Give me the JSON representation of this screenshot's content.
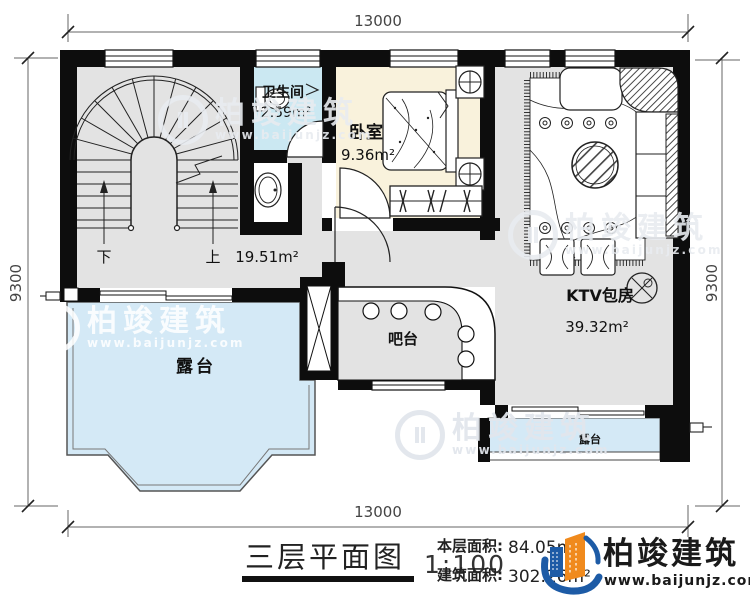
{
  "plan": {
    "dims": {
      "top": "13000",
      "bottom": "13000",
      "left": "9300",
      "right": "9300"
    },
    "rooms": {
      "hall": {
        "area": "19.51m²"
      },
      "bathroom": {
        "name": "卫生间",
        "area": "2.59m²"
      },
      "bedroom": {
        "name": "卧室",
        "area": "9.36m²"
      },
      "ktv": {
        "name": "KTV包房",
        "area": "39.32m²"
      },
      "bar": {
        "name": "吧台"
      },
      "terrace": {
        "name": "露台"
      },
      "terrace_small": {
        "name": "露台"
      }
    },
    "stairs": {
      "down": "下",
      "up": "上"
    },
    "titleblock": {
      "title": "三层平面图",
      "scale": "1:100",
      "stats": [
        {
          "label": "本层面积:",
          "value": "84.05m²"
        },
        {
          "label": "建筑面积:",
          "value": "302.26m²"
        }
      ],
      "brand": {
        "name": "柏竣建筑",
        "url": "www.baijunjz.com"
      }
    },
    "watermark": {
      "name": "柏竣建筑",
      "url": "www.baijunjz.com"
    }
  },
  "colors": {
    "wall": "#111111",
    "floor_gray": "#e3e3e3",
    "terrace_blue": "#d4e9f6",
    "bathroom_blue": "#cbe8f2",
    "bedroom_cream": "#f9f2dc",
    "brand_blue": "#1d5ba6",
    "brand_orange": "#f08a1d"
  }
}
